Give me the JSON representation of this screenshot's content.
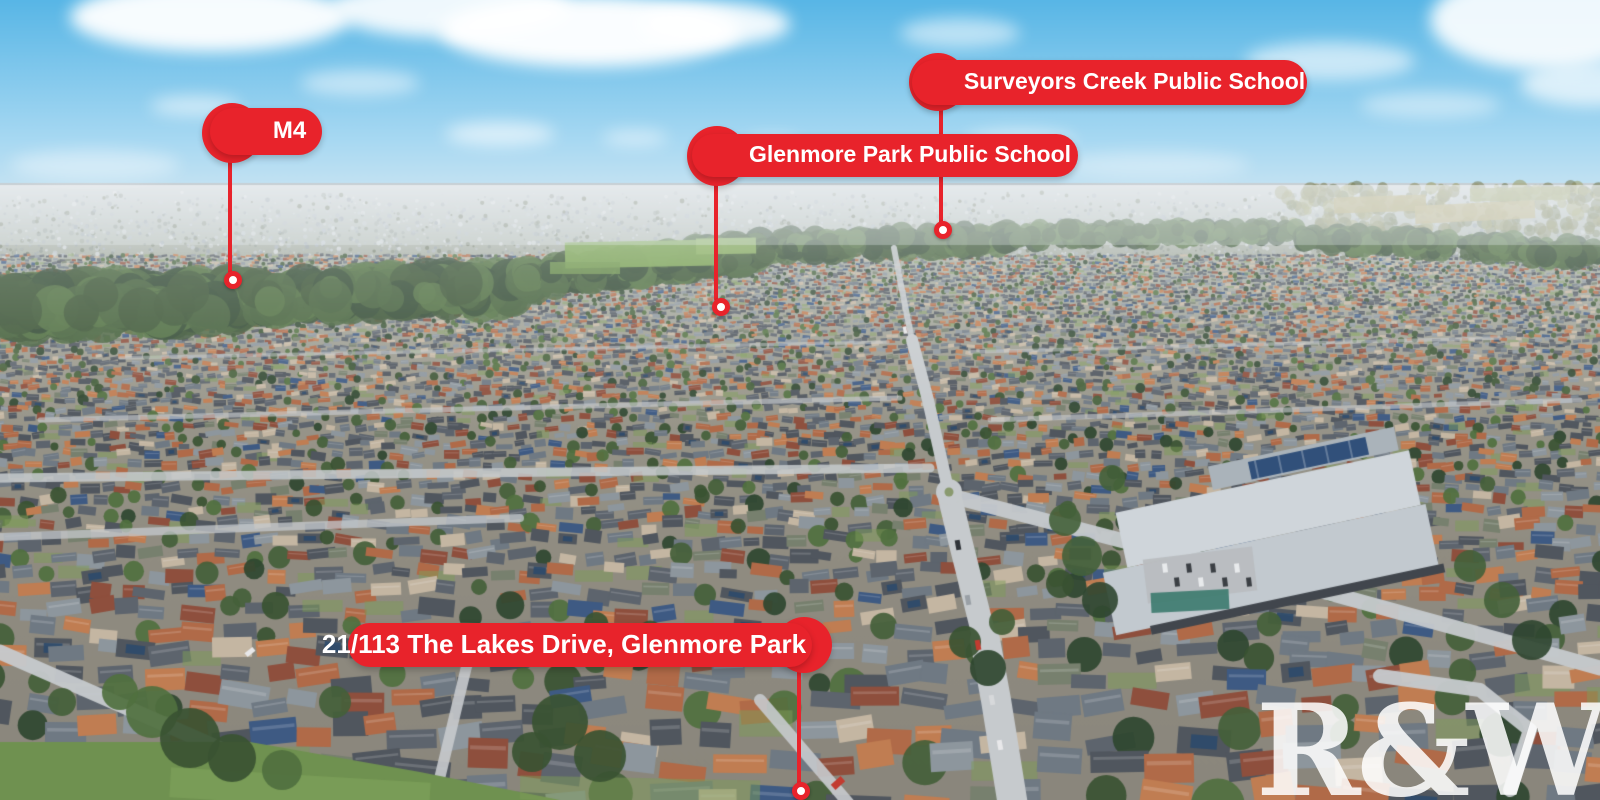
{
  "meta": {
    "title": "Aerial location overview - Glenmore Park",
    "width_px": 1600,
    "height_px": 800
  },
  "watermark": {
    "text": "R&W"
  },
  "palette": {
    "marker_red": "#e8232b",
    "marker_text": "#ffffff",
    "dot_core": "#ffffff",
    "sky_top": "#58b6e6",
    "sky_mid": "#a6d8f2",
    "sky_horizon": "#e9eff3",
    "haze": "#c7d0d6",
    "distant_city": "#a3adb6",
    "countryside_olive": "#8f9166",
    "field_green": "#7aa351",
    "tree_dark": "#3a5232",
    "lawn_green": "#6f9150",
    "roof_slate": "#50565e",
    "roof_terracotta": "#b06a48",
    "roof_brick": "#8e4f3d",
    "roof_tan": "#c4b6a2",
    "road_gray": "#c6cacd",
    "school_roof": "#cfd5da",
    "solar_blue": "#31507a",
    "court_teal": "#3c7a6e"
  },
  "markers": [
    {
      "id": "m4-motorway",
      "label": "M4",
      "font_px": 24,
      "bar": [
        210,
        108,
        112,
        47
      ],
      "circle": [
        232,
        133,
        30
      ],
      "circle_side": "left",
      "line": [
        230,
        158,
        274
      ],
      "dot": [
        233,
        280
      ]
    },
    {
      "id": "surveyors-creek-public-school",
      "label": "Surveyors Creek Public School",
      "font_px": 23,
      "bar": [
        912,
        60,
        395,
        45
      ],
      "circle": [
        938,
        82,
        29
      ],
      "circle_side": "left",
      "line": [
        941,
        104,
        224
      ],
      "dot": [
        943,
        230
      ]
    },
    {
      "id": "glenmore-park-public-school",
      "label": "Glenmore Park Public School",
      "font_px": 23,
      "bar": [
        692,
        134,
        386,
        43
      ],
      "circle": [
        717,
        156,
        30
      ],
      "circle_side": "left",
      "line": [
        716,
        182,
        301
      ],
      "dot": [
        721,
        307
      ]
    },
    {
      "id": "subject-property",
      "label": "21/113 The Lakes Drive, Glenmore Park",
      "font_px": 26,
      "bar": [
        348,
        623,
        464,
        44
      ],
      "circle": [
        804,
        645,
        28
      ],
      "circle_side": "right",
      "line": [
        799,
        670,
        785
      ],
      "dot": [
        801,
        791
      ]
    }
  ]
}
